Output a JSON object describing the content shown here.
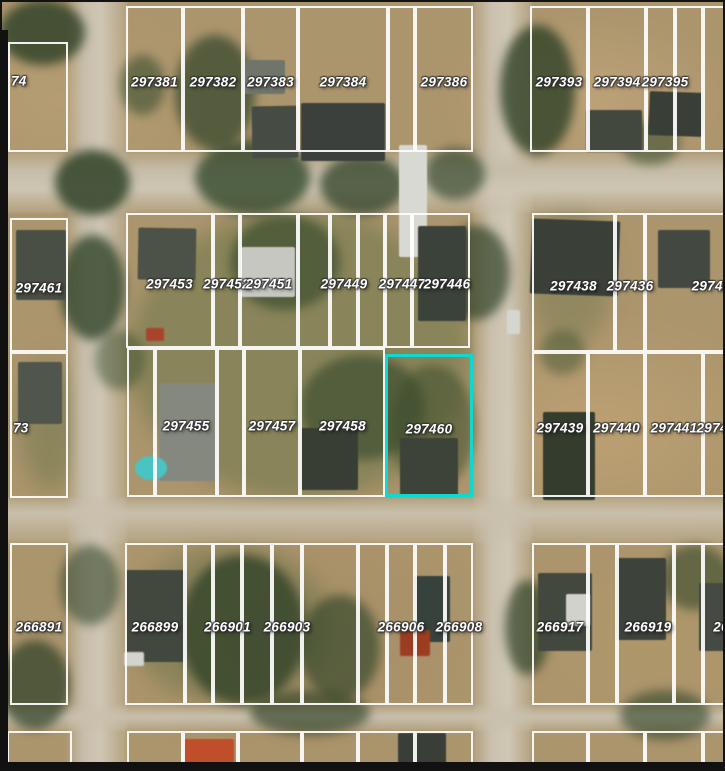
{
  "map": {
    "type": "aerial-parcel-map",
    "highlighted_parcel_id": "297460",
    "parcel_line_color": "#fdfdfd",
    "highlight_color": "#0ed9d0",
    "label_text_color": "#ffffff"
  },
  "rows": [
    {
      "name": "top-block-row",
      "y1": 6,
      "y2": 152,
      "cells": [
        {
          "id": "74",
          "x1": 8,
          "x2": 68,
          "y1": 42,
          "align": "left",
          "ly": 81
        },
        {
          "id": "297381",
          "x1": 126,
          "x2": 183
        },
        {
          "id": "297382",
          "x1": 183,
          "x2": 243
        },
        {
          "id": "297383",
          "x1": 243,
          "x2": 298
        },
        {
          "id": "297384",
          "x1": 298,
          "x2": 388
        },
        {
          "id": "",
          "x1": 388,
          "x2": 415
        },
        {
          "id": "297386",
          "x1": 415,
          "x2": 473
        },
        {
          "id": "297393",
          "x1": 530,
          "x2": 588
        },
        {
          "id": "297394",
          "x1": 588,
          "x2": 646
        },
        {
          "id": "297395",
          "x1": 646,
          "x2": 675,
          "lx": 665
        },
        {
          "id": "",
          "x1": 675,
          "x2": 703
        },
        {
          "id": "",
          "x1": 703,
          "x2": 727
        }
      ]
    },
    {
      "name": "middle-upper-row",
      "y1": 213,
      "y2": 348,
      "cells": [
        {
          "id": "297461",
          "x1": 10,
          "x2": 68,
          "y1": 218,
          "y2": 352
        },
        {
          "id": "297453",
          "x1": 126,
          "x2": 213
        },
        {
          "id": "297452",
          "x1": 213,
          "x2": 240
        },
        {
          "id": "297451",
          "x1": 240,
          "x2": 298
        },
        {
          "id": "",
          "x1": 298,
          "x2": 330
        },
        {
          "id": "297449",
          "x1": 330,
          "x2": 358
        },
        {
          "id": "",
          "x1": 358,
          "x2": 385
        },
        {
          "id": "297447",
          "x1": 385,
          "x2": 412,
          "lx": 402
        },
        {
          "id": "297446",
          "x1": 412,
          "x2": 470,
          "lx": 447
        },
        {
          "id": "297438",
          "x1": 532,
          "x2": 615,
          "y2": 352
        },
        {
          "id": "297436",
          "x1": 615,
          "x2": 645,
          "y2": 352
        },
        {
          "id": "297436",
          "x1": 645,
          "x2": 727,
          "y2": 352,
          "lx": 715
        }
      ]
    },
    {
      "name": "middle-lower-row",
      "y1": 348,
      "y2": 497,
      "cells": [
        {
          "id": "73",
          "x1": 10,
          "x2": 68,
          "y1": 352,
          "y2": 498,
          "align": "left"
        },
        {
          "id": "",
          "x1": 127,
          "x2": 155
        },
        {
          "id": "297455",
          "x1": 155,
          "x2": 217
        },
        {
          "id": "",
          "x1": 217,
          "x2": 244
        },
        {
          "id": "297457",
          "x1": 244,
          "x2": 300
        },
        {
          "id": "297458",
          "x1": 300,
          "x2": 385
        },
        {
          "id": "297460",
          "x1": 385,
          "x2": 473,
          "y1": 354,
          "highlighted": true
        },
        {
          "id": "297439",
          "x1": 532,
          "x2": 588,
          "y1": 352
        },
        {
          "id": "297440",
          "x1": 588,
          "x2": 645,
          "y1": 352
        },
        {
          "id": "297441",
          "x1": 645,
          "x2": 703,
          "y1": 352
        },
        {
          "id": "29744",
          "x1": 703,
          "x2": 727,
          "y1": 352,
          "lx": 716
        }
      ]
    },
    {
      "name": "bottom-block-row",
      "y1": 543,
      "y2": 705,
      "cells": [
        {
          "id": "266891",
          "x1": 10,
          "x2": 68
        },
        {
          "id": "266899",
          "x1": 125,
          "x2": 185
        },
        {
          "id": "",
          "x1": 185,
          "x2": 213
        },
        {
          "id": "266901",
          "x1": 213,
          "x2": 242
        },
        {
          "id": "",
          "x1": 242,
          "x2": 272
        },
        {
          "id": "266903",
          "x1": 272,
          "x2": 302
        },
        {
          "id": "",
          "x1": 302,
          "x2": 358
        },
        {
          "id": "",
          "x1": 358,
          "x2": 387
        },
        {
          "id": "266906",
          "x1": 387,
          "x2": 415
        },
        {
          "id": "",
          "x1": 415,
          "x2": 445
        },
        {
          "id": "266908",
          "x1": 445,
          "x2": 473
        },
        {
          "id": "266917",
          "x1": 532,
          "x2": 588
        },
        {
          "id": "",
          "x1": 588,
          "x2": 617
        },
        {
          "id": "266919",
          "x1": 617,
          "x2": 674,
          "lx": 648
        },
        {
          "id": "",
          "x1": 674,
          "x2": 703
        },
        {
          "id": "26",
          "x1": 703,
          "x2": 727,
          "lx": 721
        }
      ]
    },
    {
      "name": "bottom-edge-strip",
      "y1": 731,
      "y2": 769,
      "cells": [
        {
          "id": "",
          "x1": 7,
          "x2": 72
        },
        {
          "id": "",
          "x1": 127,
          "x2": 183
        },
        {
          "id": "",
          "x1": 183,
          "x2": 238
        },
        {
          "id": "",
          "x1": 238,
          "x2": 302
        },
        {
          "id": "",
          "x1": 302,
          "x2": 358
        },
        {
          "id": "",
          "x1": 358,
          "x2": 415
        },
        {
          "id": "",
          "x1": 415,
          "x2": 473
        },
        {
          "id": "",
          "x1": 532,
          "x2": 588
        },
        {
          "id": "",
          "x1": 588,
          "x2": 645
        },
        {
          "id": "",
          "x1": 645,
          "x2": 703
        },
        {
          "id": "",
          "x1": 703,
          "x2": 727
        }
      ]
    }
  ]
}
